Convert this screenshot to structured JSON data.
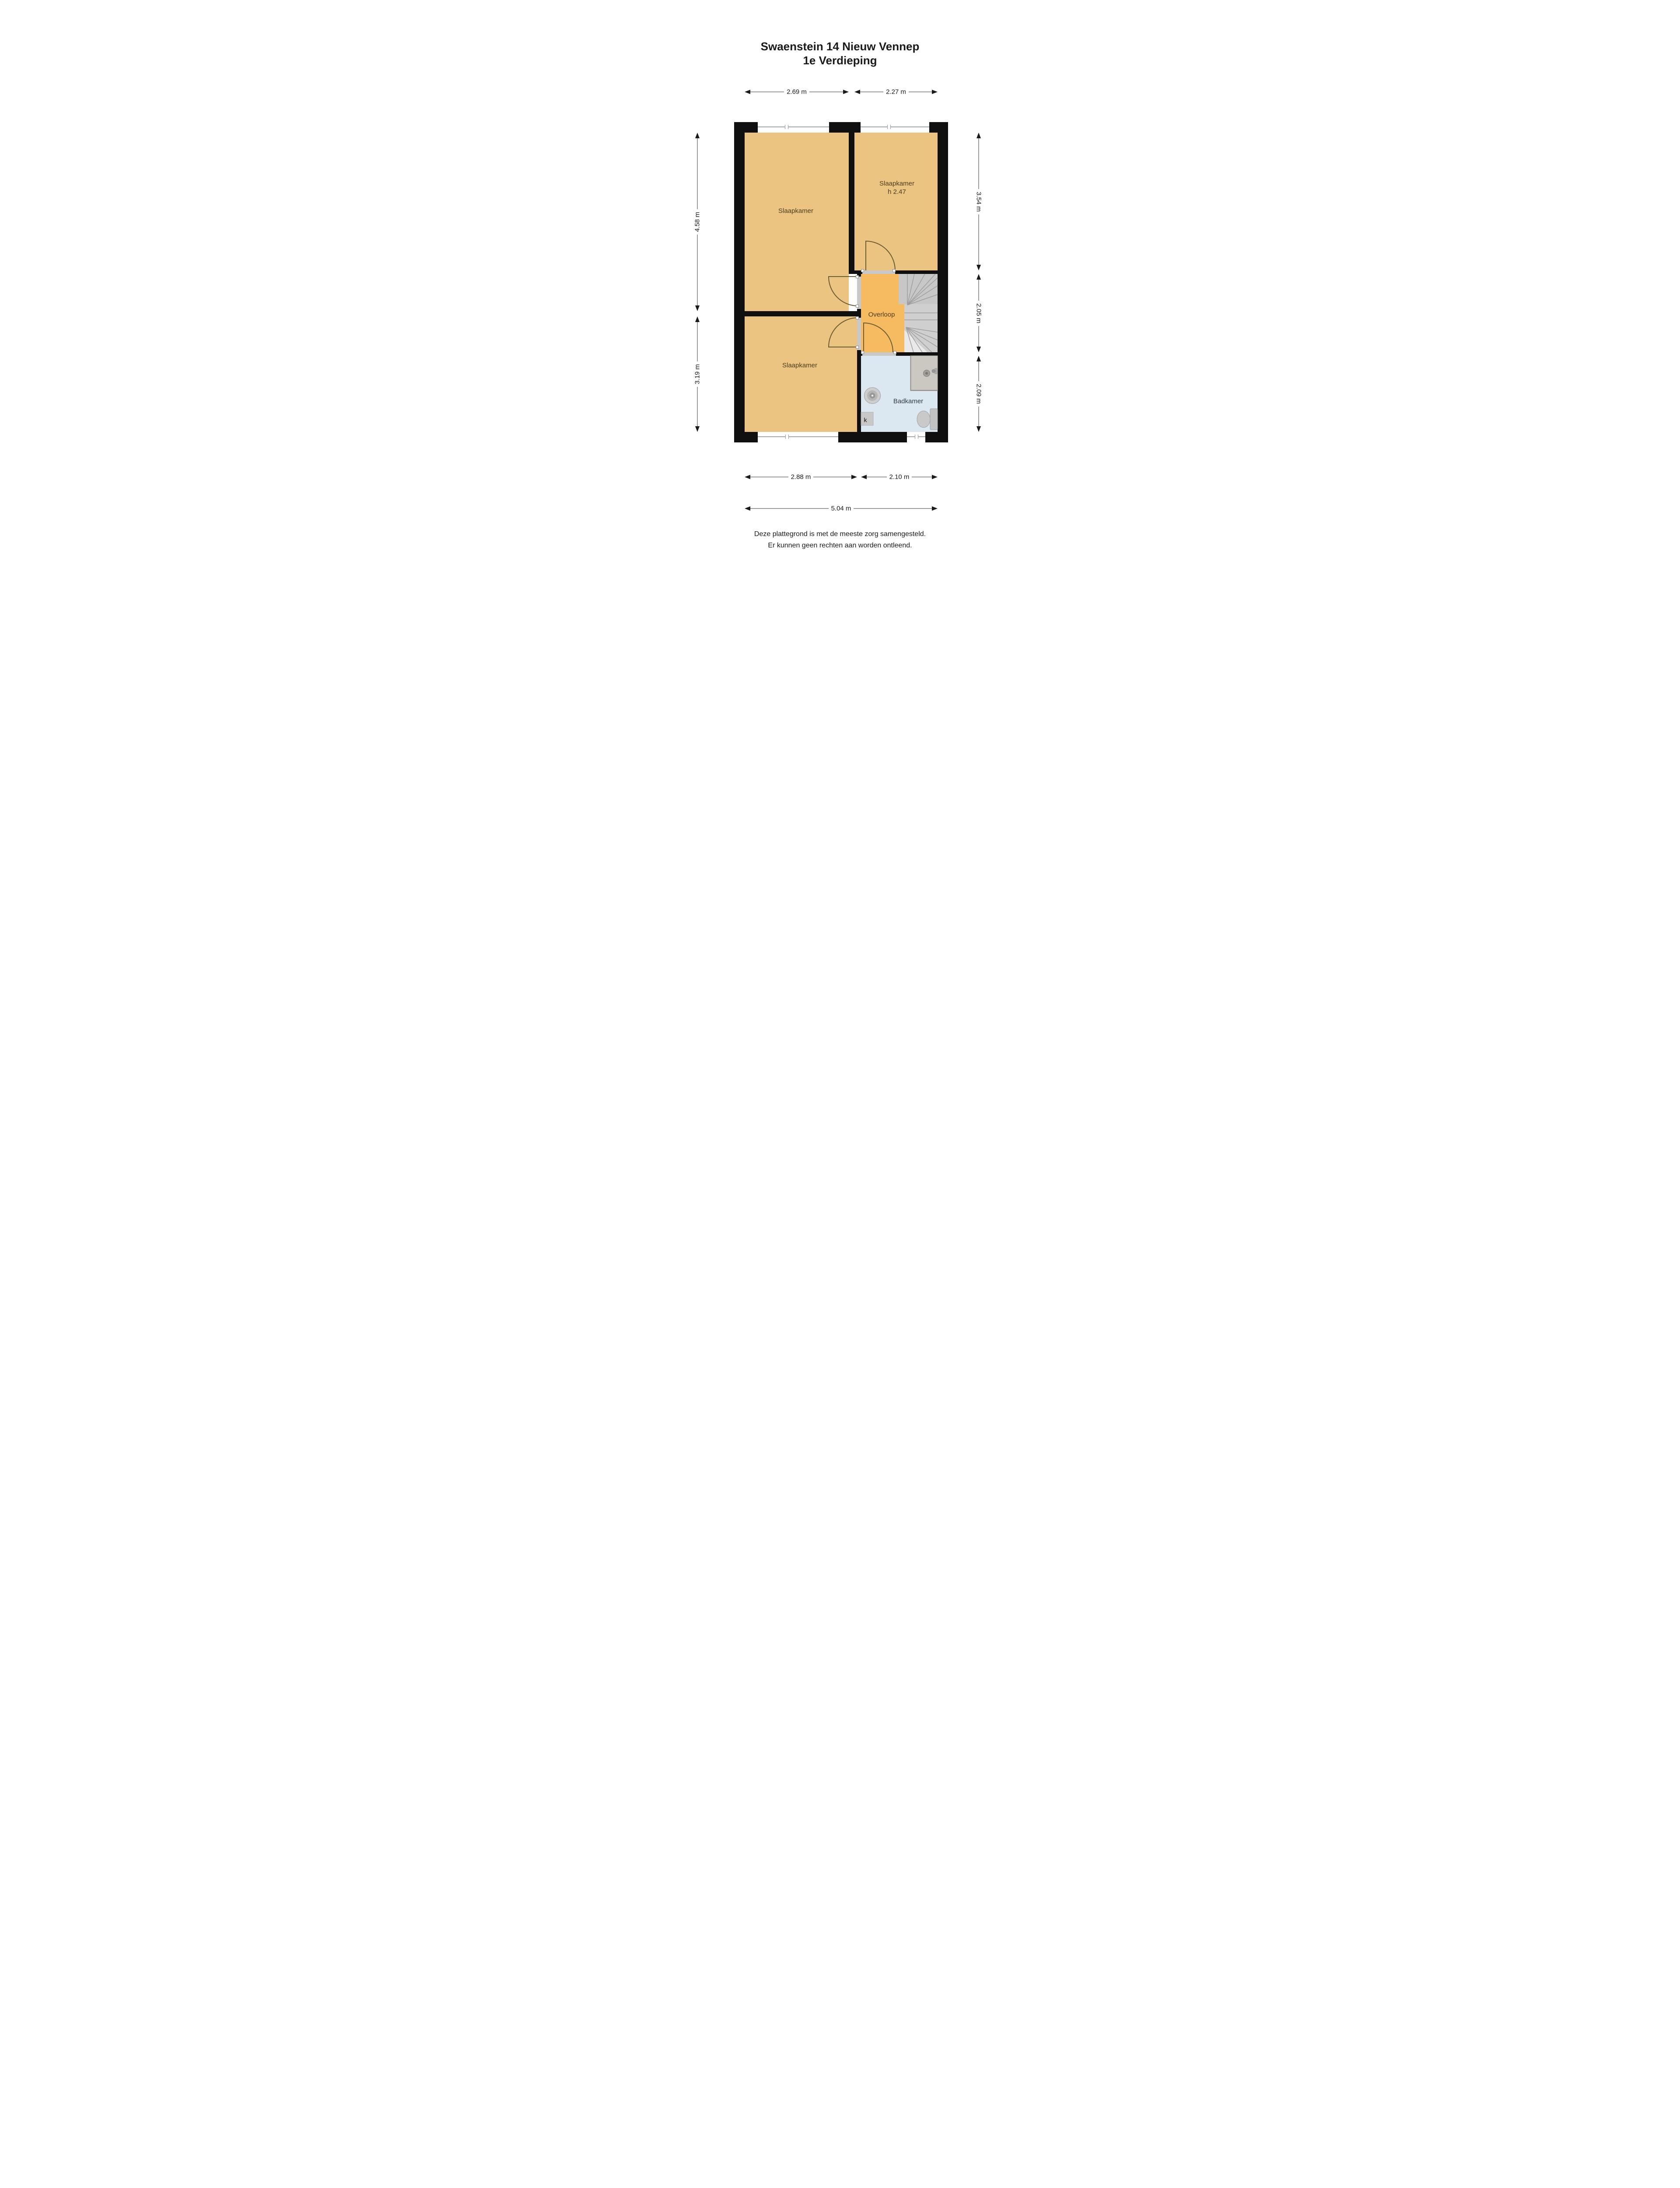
{
  "title": {
    "line1": "Swaenstein 14 Nieuw Vennep",
    "line2": "1e Verdieping"
  },
  "rooms": {
    "bedroom_top_left": {
      "label": "Slaapkamer"
    },
    "bedroom_top_right": {
      "label": "Slaapkamer",
      "height_note": "h 2.47"
    },
    "bedroom_bottom_left": {
      "label": "Slaapkamer"
    },
    "landing": {
      "label": "Overloop"
    },
    "bathroom": {
      "label": "Badkamer"
    },
    "closet": {
      "label": "k"
    }
  },
  "dimensions": {
    "top": [
      "2.69 m",
      "2.27 m"
    ],
    "left": [
      "4.58 m",
      "3.19 m"
    ],
    "right": [
      "3.54 m",
      "2.05 m",
      "2.09 m"
    ],
    "bottom_inner": [
      "2.88 m",
      "2.10 m"
    ],
    "bottom_total": "5.04 m"
  },
  "disclaimer": {
    "line1": "Deze plattegrond is met de meeste zorg samengesteld.",
    "line2": "Er kunnen geen rechten aan worden ontleend."
  },
  "colors": {
    "wall": "#0f0f0f",
    "bedroom_fill": "#eac480",
    "landing_fill": "#f6ba60",
    "bathroom_fill": "#dbe7f1",
    "stairs_fill": "#c7c7c7",
    "door_arc": "#6b5d35",
    "dimension_line": "#9b9b9b",
    "room_label_text": "#4a3c20"
  }
}
